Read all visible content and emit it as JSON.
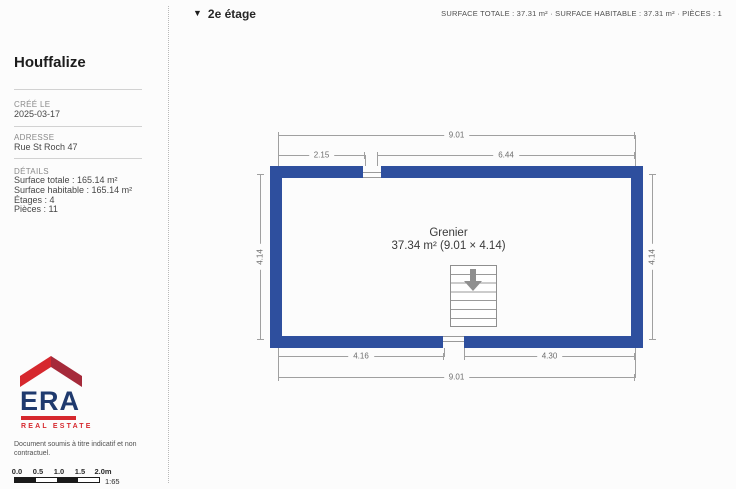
{
  "sidebar": {
    "title": "Houffalize",
    "created_label": "CRÉÉ LE",
    "created_value": "2025-03-17",
    "address_label": "ADRESSE",
    "address_value": "Rue St Roch 47",
    "details_label": "DÉTAILS",
    "details": [
      "Surface totale : 165.14 m²",
      "Surface habitable : 165.14 m²",
      "Étages : 4",
      "Pièces : 11"
    ]
  },
  "header": {
    "marker": "▼",
    "floor_label": "2e étage",
    "stats": "SURFACE TOTALE : 37.31 m² · SURFACE HABITABLE : 37.31 m² · PIÈCES : 1"
  },
  "plan": {
    "room": {
      "name": "Grenier",
      "area_line": "37.34 m² (9.01 × 4.14)"
    },
    "dims": {
      "top_total": "9.01",
      "top_left": "2.15",
      "top_right": "6.44",
      "side_left": "4.14",
      "side_right": "4.14",
      "bottom_left": "4.16",
      "bottom_right": "4.30",
      "bottom_total": "9.01"
    }
  },
  "logo": {
    "brand": "ERA",
    "tagline": "REAL ESTATE"
  },
  "disclaimer": "Document soumis à titre indicatif et non contractuel.",
  "scale": {
    "labels": [
      "0.0",
      "0.5",
      "1.0",
      "1.5",
      "2.0m"
    ],
    "ratio": "1:65"
  },
  "colors": {
    "wall": "#2e4f9e",
    "era_red": "#d6282e",
    "era_dark_red": "#a52a3a",
    "era_navy": "#1f3a6e"
  }
}
